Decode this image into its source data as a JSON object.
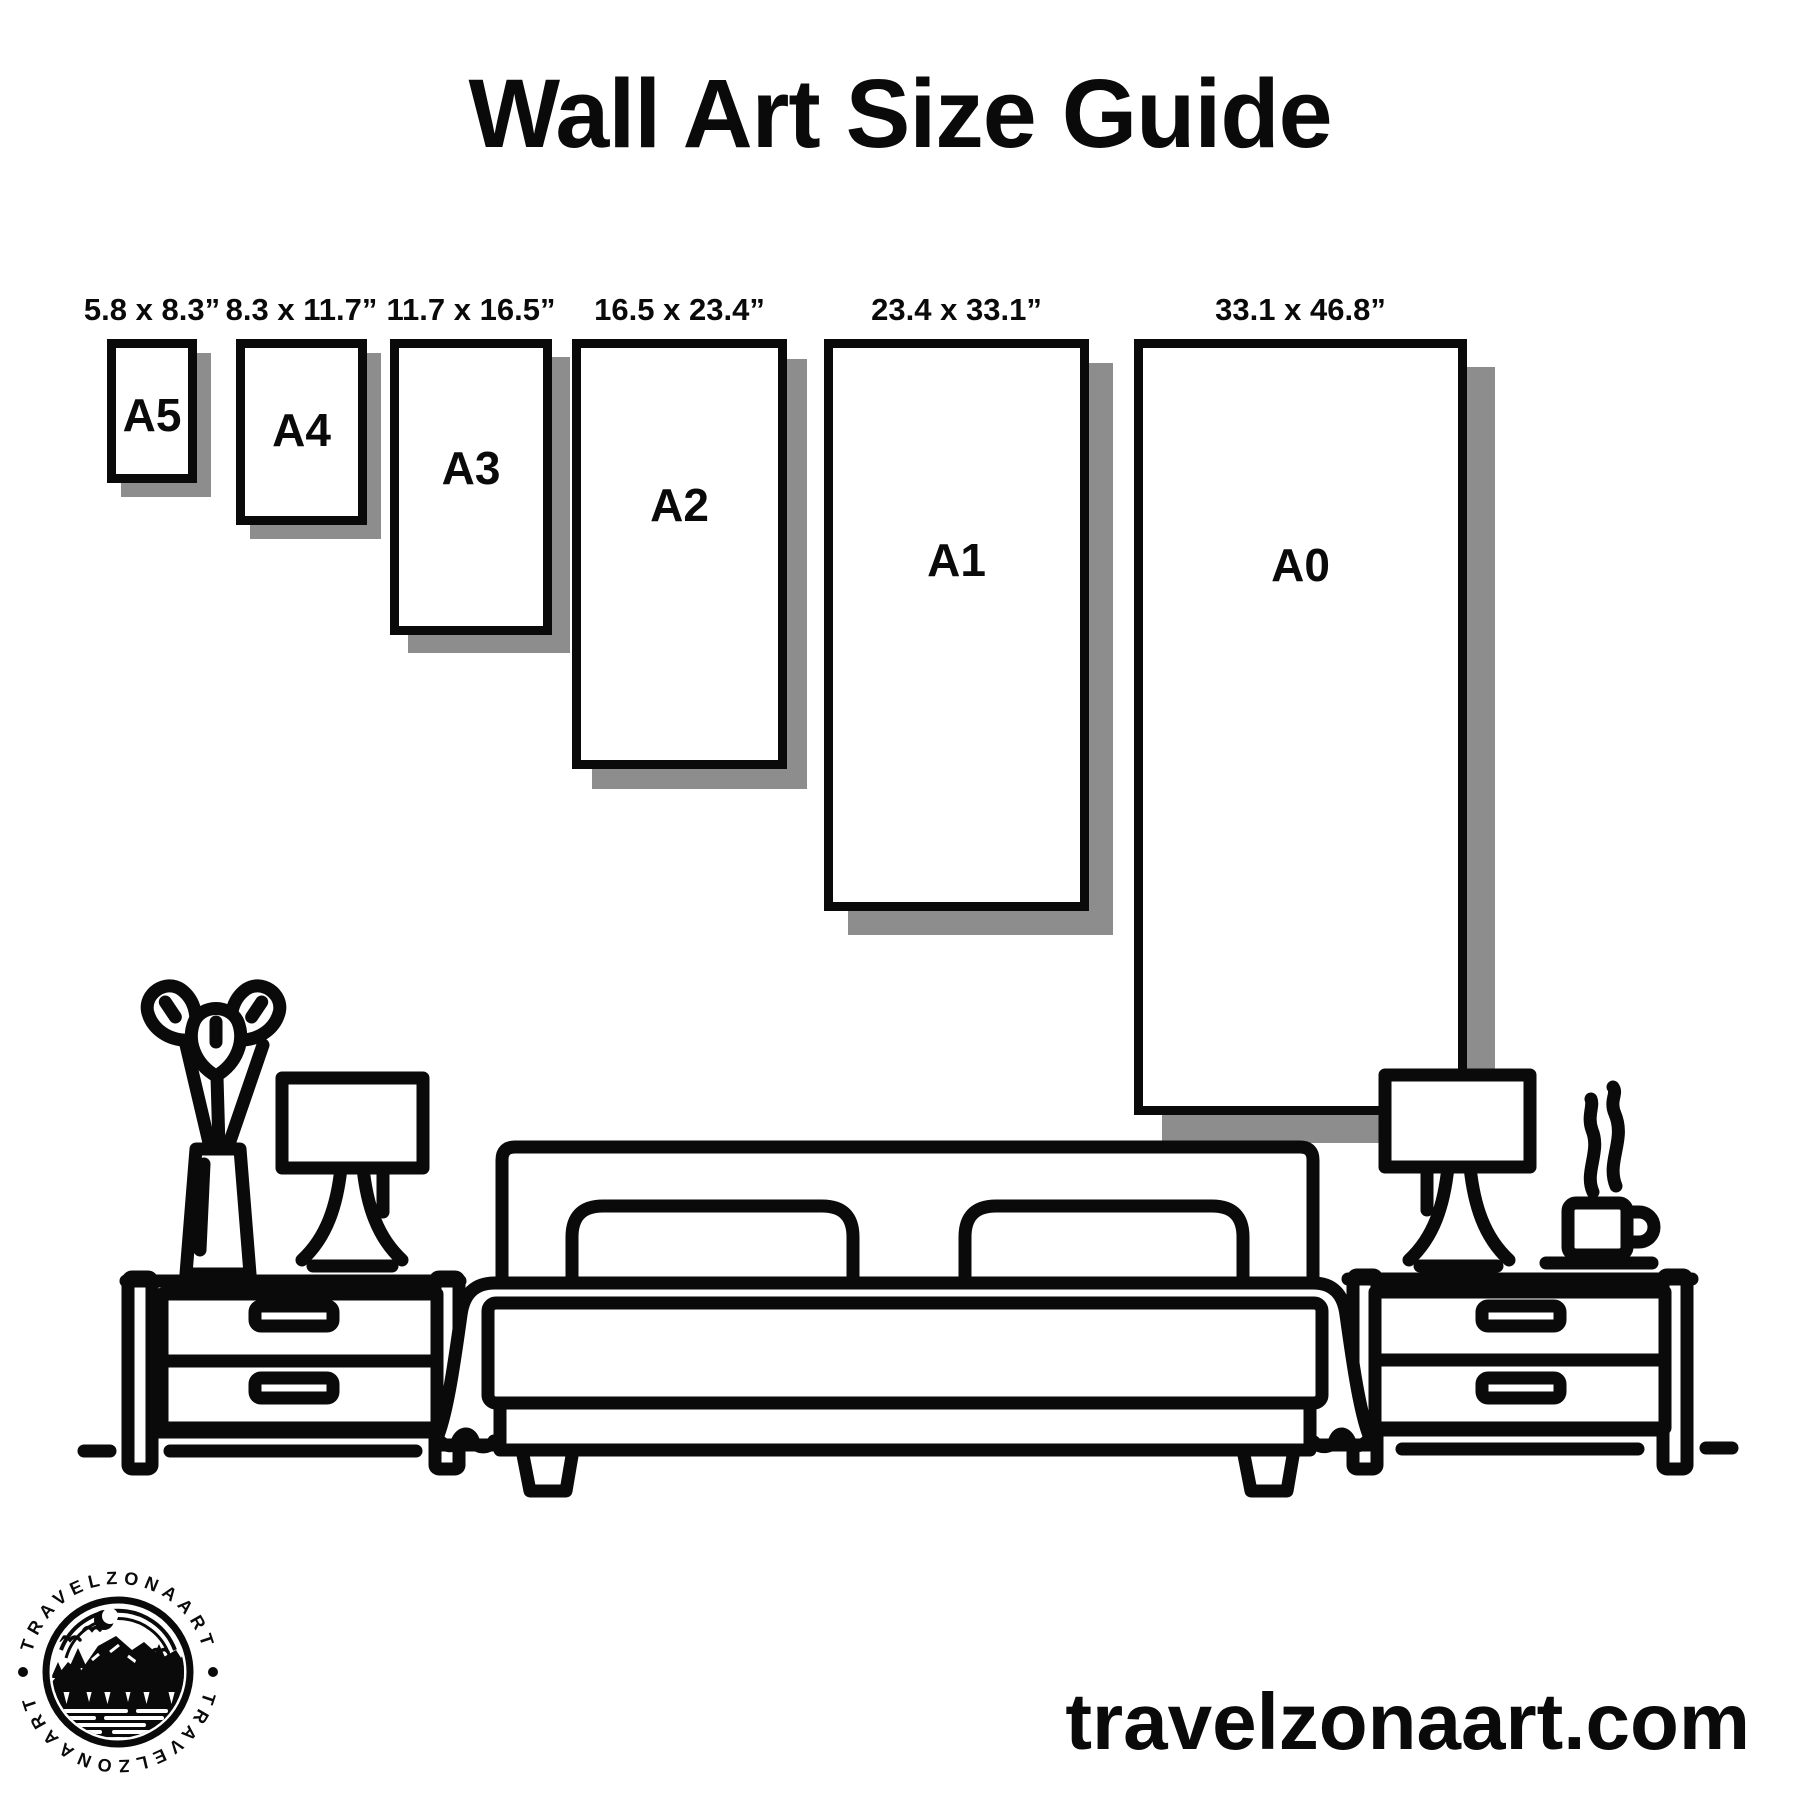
{
  "title": "Wall Art Size Guide",
  "frames": [
    {
      "id": "a5",
      "label": "A5",
      "size": "5.8 x 8.3”"
    },
    {
      "id": "a4",
      "label": "A4",
      "size": "8.3 x 11.7”"
    },
    {
      "id": "a3",
      "label": "A3",
      "size": "11.7 x 16.5”"
    },
    {
      "id": "a2",
      "label": "A2",
      "size": "16.5 x 23.4”"
    },
    {
      "id": "a1",
      "label": "A1",
      "size": "23.4 x 33.1”"
    },
    {
      "id": "a0",
      "label": "A0",
      "size": "33.1 x 46.8”"
    }
  ],
  "logo": {
    "brand_top": "TRAVELZONAART",
    "brand_bottom": "TRAVELZONAART"
  },
  "footer": {
    "website": "travelzonaart.com"
  },
  "colors": {
    "ink": "#0a0a0a",
    "shadow": "#8d8d8d",
    "background": "#ffffff"
  }
}
